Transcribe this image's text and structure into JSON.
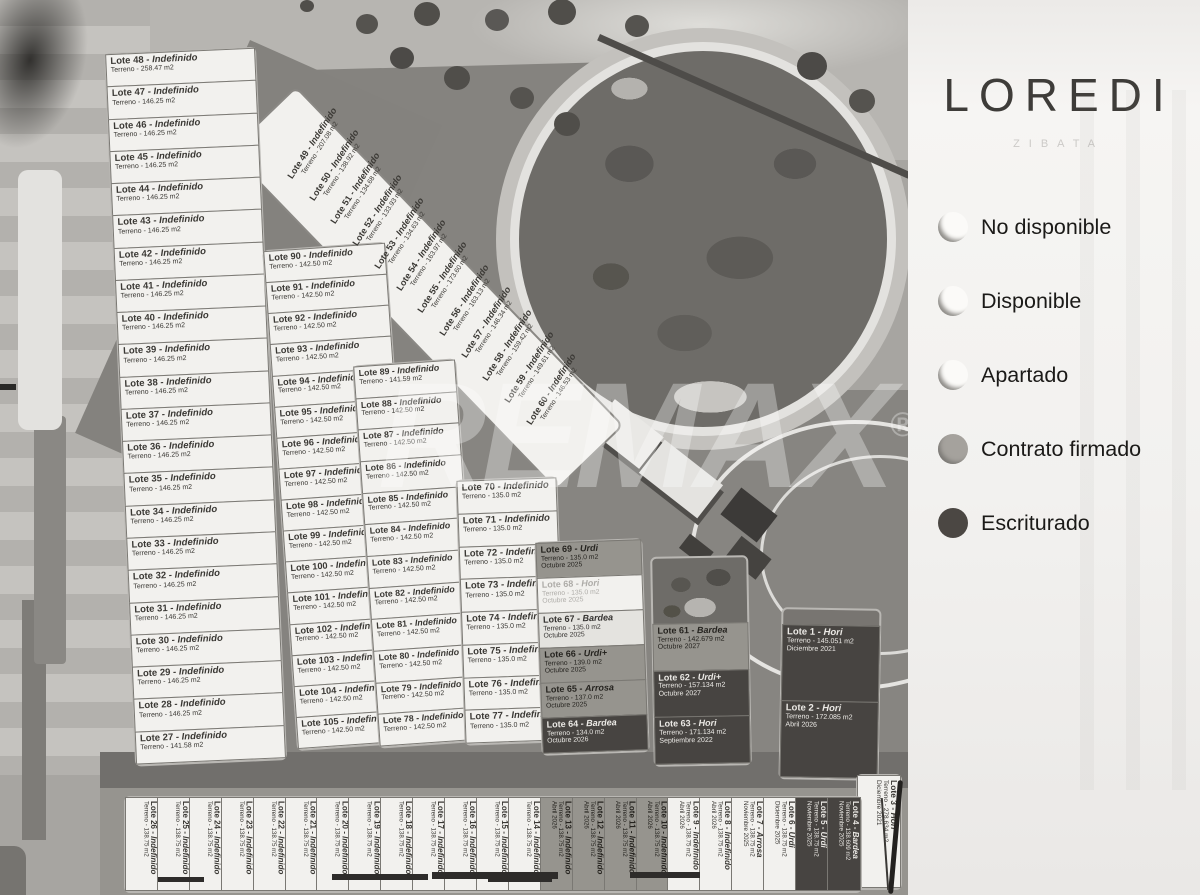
{
  "brand": {
    "title": "LOREDI",
    "subtitle": "ZIBATA"
  },
  "watermark": {
    "text": "REMAX",
    "reg": "®"
  },
  "legend": {
    "items": [
      {
        "label": "No disponible",
        "tone": "light",
        "color": "#fbfaf8"
      },
      {
        "label": "Disponible",
        "tone": "light",
        "color": "#fbfaf8"
      },
      {
        "label": "Apartado",
        "tone": "light",
        "color": "#fbfaf8"
      },
      {
        "label": "Contrato firmado",
        "tone": "mid",
        "color": "#a5a29d"
      },
      {
        "label": "Escriturado",
        "tone": "dark",
        "color": "#4b4743"
      }
    ]
  },
  "lots": {
    "left_column": [
      {
        "lot": "Lote 48",
        "name": "Indefinido",
        "terreno": "Terreno - 258.47 m2",
        "status": "white"
      },
      {
        "lot": "Lote 47",
        "name": "Indefinido",
        "terreno": "Terreno - 146.25 m2",
        "status": "white"
      },
      {
        "lot": "Lote 46",
        "name": "Indefinido",
        "terreno": "Terreno - 146.25 m2",
        "status": "white"
      },
      {
        "lot": "Lote 45",
        "name": "Indefinido",
        "terreno": "Terreno - 146.25 m2",
        "status": "white"
      },
      {
        "lot": "Lote 44",
        "name": "Indefinido",
        "terreno": "Terreno - 146.25 m2",
        "status": "white"
      },
      {
        "lot": "Lote 43",
        "name": "Indefinido",
        "terreno": "Terreno - 146.25 m2",
        "status": "white"
      },
      {
        "lot": "Lote 42",
        "name": "Indefinido",
        "terreno": "Terreno - 146.25 m2",
        "status": "white"
      },
      {
        "lot": "Lote 41",
        "name": "Indefinido",
        "terreno": "Terreno - 146.25 m2",
        "status": "white"
      },
      {
        "lot": "Lote 40",
        "name": "Indefinido",
        "terreno": "Terreno - 146.25 m2",
        "status": "white"
      },
      {
        "lot": "Lote 39",
        "name": "Indefinido",
        "terreno": "Terreno - 146.25 m2",
        "status": "white"
      },
      {
        "lot": "Lote 38",
        "name": "Indefinido",
        "terreno": "Terreno - 146.25 m2",
        "status": "white"
      },
      {
        "lot": "Lote 37",
        "name": "Indefinido",
        "terreno": "Terreno - 146.25 m2",
        "status": "white"
      },
      {
        "lot": "Lote 36",
        "name": "Indefinido",
        "terreno": "Terreno - 146.25 m2",
        "status": "white"
      },
      {
        "lot": "Lote 35",
        "name": "Indefinido",
        "terreno": "Terreno - 146.25 m2",
        "status": "white"
      },
      {
        "lot": "Lote 34",
        "name": "Indefinido",
        "terreno": "Terreno - 146.25 m2",
        "status": "white"
      },
      {
        "lot": "Lote 33",
        "name": "Indefinido",
        "terreno": "Terreno - 146.25 m2",
        "status": "white"
      },
      {
        "lot": "Lote 32",
        "name": "Indefinido",
        "terreno": "Terreno - 146.25 m2",
        "status": "white"
      },
      {
        "lot": "Lote 31",
        "name": "Indefinido",
        "terreno": "Terreno - 146.25 m2",
        "status": "white"
      },
      {
        "lot": "Lote 30",
        "name": "Indefinido",
        "terreno": "Terreno - 146.25 m2",
        "status": "white"
      },
      {
        "lot": "Lote 29",
        "name": "Indefinido",
        "terreno": "Terreno - 146.25 m2",
        "status": "white"
      },
      {
        "lot": "Lote 28",
        "name": "Indefinido",
        "terreno": "Terreno - 146.25 m2",
        "status": "white"
      },
      {
        "lot": "Lote 27",
        "name": "Indefinido",
        "terreno": "Terreno - 141.58 m2",
        "status": "white"
      }
    ],
    "diagonal": [
      {
        "lot": "Lote 49",
        "name": "Indefinido",
        "terreno": "Terreno - 207.08 m2",
        "status": "white"
      },
      {
        "lot": "Lote 50",
        "name": "Indefinido",
        "terreno": "Terreno - 138.92 m2",
        "status": "white"
      },
      {
        "lot": "Lote 51",
        "name": "Indefinido",
        "terreno": "Terreno - 134.68 m2",
        "status": "white"
      },
      {
        "lot": "Lote 52",
        "name": "Indefinido",
        "terreno": "Terreno - 133.93 m2",
        "status": "white"
      },
      {
        "lot": "Lote 53",
        "name": "Indefinido",
        "terreno": "Terreno - 134.63 m2",
        "status": "white"
      },
      {
        "lot": "Lote 54",
        "name": "Indefinido",
        "terreno": "Terreno - 163.97 m2",
        "status": "white"
      },
      {
        "lot": "Lote 55",
        "name": "Indefinido",
        "terreno": "Terreno - 173.60 m2",
        "status": "white"
      },
      {
        "lot": "Lote 56",
        "name": "Indefinido",
        "terreno": "Terreno - 163.13 m2",
        "status": "white"
      },
      {
        "lot": "Lote 57",
        "name": "Indefinido",
        "terreno": "Terreno - 146.34 m2",
        "status": "white"
      },
      {
        "lot": "Lote 58",
        "name": "Indefinido",
        "terreno": "Terreno - 159.42 m2",
        "status": "white"
      },
      {
        "lot": "Lote 59",
        "name": "Indefinido",
        "terreno": "Terreno - 149.61 m2",
        "status": "white"
      },
      {
        "lot": "Lote 60",
        "name": "Indefinido",
        "terreno": "Terreno - 146.53 m2",
        "status": "white"
      }
    ],
    "col_90s": [
      {
        "lot": "Lote 90",
        "name": "Indefinido",
        "terreno": "Terreno - 142.50 m2",
        "status": "white"
      },
      {
        "lot": "Lote 91",
        "name": "Indefinido",
        "terreno": "Terreno - 142.50 m2",
        "status": "white"
      },
      {
        "lot": "Lote 92",
        "name": "Indefinido",
        "terreno": "Terreno - 142.50 m2",
        "status": "white"
      },
      {
        "lot": "Lote 93",
        "name": "Indefinido",
        "terreno": "Terreno - 142.50 m2",
        "status": "white"
      },
      {
        "lot": "Lote 94",
        "name": "Indefinido",
        "terreno": "Terreno - 142.50 m2",
        "status": "white"
      },
      {
        "lot": "Lote 95",
        "name": "Indefinido",
        "terreno": "Terreno - 142.50 m2",
        "status": "white"
      },
      {
        "lot": "Lote 96",
        "name": "Indefinido",
        "terreno": "Terreno - 142.50 m2",
        "status": "white"
      },
      {
        "lot": "Lote 97",
        "name": "Indefinido",
        "terreno": "Terreno - 142.50 m2",
        "status": "white"
      },
      {
        "lot": "Lote 98",
        "name": "Indefinido",
        "terreno": "Terreno - 142.50 m2",
        "status": "white"
      },
      {
        "lot": "Lote 99",
        "name": "Indefinido",
        "terreno": "Terreno - 142.50 m2",
        "status": "white"
      },
      {
        "lot": "Lote 100",
        "name": "Indefinido",
        "terreno": "Terreno - 142.50 m2",
        "status": "white"
      },
      {
        "lot": "Lote 101",
        "name": "Indefinido",
        "terreno": "Terreno - 142.50 m2",
        "status": "white"
      },
      {
        "lot": "Lote 102",
        "name": "Indefinido",
        "terreno": "Terreno - 142.50 m2",
        "status": "white"
      },
      {
        "lot": "Lote 103",
        "name": "Indefinido",
        "terreno": "Terreno - 142.50 m2",
        "status": "white"
      },
      {
        "lot": "Lote 104",
        "name": "Indefinido",
        "terreno": "Terreno - 142.50 m2",
        "status": "white"
      },
      {
        "lot": "Lote 105",
        "name": "Indefinido",
        "terreno": "Terreno - 142.50 m2",
        "status": "white"
      }
    ],
    "col_80s": [
      {
        "lot": "Lote 89",
        "name": "Indefinido",
        "terreno": "Terreno - 141.59 m2",
        "status": "white"
      },
      {
        "lot": "Lote 88",
        "name": "Indefinido",
        "terreno": "Terreno - 142.50 m2",
        "status": "white"
      },
      {
        "lot": "Lote 87",
        "name": "Indefinido",
        "terreno": "Terreno - 142.50 m2",
        "status": "white"
      },
      {
        "lot": "Lote 86",
        "name": "Indefinido",
        "terreno": "Terreno - 142.50 m2",
        "status": "white"
      },
      {
        "lot": "Lote 85",
        "name": "Indefinido",
        "terreno": "Terreno - 142.50 m2",
        "status": "white"
      },
      {
        "lot": "Lote 84",
        "name": "Indefinido",
        "terreno": "Terreno - 142.50 m2",
        "status": "white"
      },
      {
        "lot": "Lote 83",
        "name": "Indefinido",
        "terreno": "Terreno - 142.50 m2",
        "status": "white"
      },
      {
        "lot": "Lote 82",
        "name": "Indefinido",
        "terreno": "Terreno - 142.50 m2",
        "status": "white"
      },
      {
        "lot": "Lote 81",
        "name": "Indefinido",
        "terreno": "Terreno - 142.50 m2",
        "status": "white"
      },
      {
        "lot": "Lote 80",
        "name": "Indefinido",
        "terreno": "Terreno - 142.50 m2",
        "status": "white"
      },
      {
        "lot": "Lote 79",
        "name": "Indefinido",
        "terreno": "Terreno - 142.50 m2",
        "status": "white"
      },
      {
        "lot": "Lote 78",
        "name": "Indefinido",
        "terreno": "Terreno - 142.50 m2",
        "status": "white"
      }
    ],
    "col_70s": [
      {
        "lot": "Lote 70",
        "name": "Indefinido",
        "terreno": "Terreno - 135.0 m2",
        "status": "white"
      },
      {
        "lot": "Lote 71",
        "name": "Indefinido",
        "terreno": "Terreno - 135.0 m2",
        "status": "white"
      },
      {
        "lot": "Lote 72",
        "name": "Indefinido",
        "terreno": "Terreno - 135.0 m2",
        "status": "white"
      },
      {
        "lot": "Lote 73",
        "name": "Indefinido",
        "terreno": "Terreno - 135.0 m2",
        "status": "white"
      },
      {
        "lot": "Lote 74",
        "name": "Indefinido",
        "terreno": "Terreno - 135.0 m2",
        "status": "white"
      },
      {
        "lot": "Lote 75",
        "name": "Indefinido",
        "terreno": "Terreno - 135.0 m2",
        "status": "white"
      },
      {
        "lot": "Lote 76",
        "name": "Indefinido",
        "terreno": "Terreno - 135.0 m2",
        "status": "white"
      },
      {
        "lot": "Lote 77",
        "name": "Indefinido",
        "terreno": "Terreno - 135.0 m2",
        "status": "white"
      }
    ],
    "col_60s": [
      {
        "lot": "Lote 69",
        "name": "Urdi",
        "terreno": "Terreno - 135.0 m2",
        "date": "Octubre 2025",
        "status": "gray"
      },
      {
        "lot": "Lote 68",
        "name": "Hori",
        "terreno": "Terreno - 135.0 m2",
        "date": "Octubre 2025",
        "status": "faint"
      },
      {
        "lot": "Lote 67",
        "name": "Bardea",
        "terreno": "Terreno - 135.0 m2",
        "date": "Octubre 2025",
        "status": "light"
      },
      {
        "lot": "Lote 66",
        "name": "Urdi+",
        "terreno": "Terreno - 139.0 m2",
        "date": "Octubre 2025",
        "status": "gray"
      },
      {
        "lot": "Lote 65",
        "name": "Arrosa",
        "terreno": "Terreno - 137.0 m2",
        "date": "Octubre 2025",
        "status": "gray"
      },
      {
        "lot": "Lote 64",
        "name": "Bardea",
        "terreno": "Terreno - 134.0 m2",
        "date": "Octubre 2026",
        "status": "dark"
      }
    ],
    "block_61_63": [
      {
        "lot": "Lote 61",
        "name": "Bardea",
        "terreno": "Terreno - 142.679 m2",
        "date": "Octubre 2027",
        "status": "gray"
      },
      {
        "lot": "Lote 62",
        "name": "Urdi+",
        "terreno": "Terreno - 157.134 m2",
        "date": "Octubre 2027",
        "status": "dark"
      },
      {
        "lot": "Lote 63",
        "name": "Hori",
        "terreno": "Terreno - 171.134 m2",
        "date": "Septiembre 2022",
        "status": "dark"
      }
    ],
    "block_1_2": [
      {
        "lot": "Lote 1",
        "name": "Hori",
        "terreno": "Terreno - 145.051 m2",
        "date": "Diciembre 2021",
        "status": "dark"
      },
      {
        "lot": "Lote 2",
        "name": "Hori",
        "terreno": "Terreno - 172.085 m2",
        "date": "Abril 2026",
        "status": "dark"
      }
    ],
    "lot_3": [
      {
        "lot": "Lote 3",
        "name": "Hori",
        "terreno": "Terreno - 278.634 m2",
        "date": "Diciembre 2021",
        "status": "white"
      }
    ],
    "bottom_row": [
      {
        "lot": "Lote 26",
        "name": "Indefinido",
        "terreno": "Terreno - 138.75 m2",
        "status": "white"
      },
      {
        "lot": "Lote 25",
        "name": "Indefinido",
        "terreno": "Terreno - 138.75 m2",
        "status": "white"
      },
      {
        "lot": "Lote 24",
        "name": "Indefinido",
        "terreno": "Terreno - 138.75 m2",
        "status": "white"
      },
      {
        "lot": "Lote 23",
        "name": "Indefinido",
        "terreno": "Terreno - 138.75 m2",
        "status": "white"
      },
      {
        "lot": "Lote 22",
        "name": "Indefinido",
        "terreno": "Terreno - 138.75 m2",
        "status": "white"
      },
      {
        "lot": "Lote 21",
        "name": "Indefinido",
        "terreno": "Terreno - 138.75 m2",
        "status": "white"
      },
      {
        "lot": "Lote 20",
        "name": "Indefinido",
        "terreno": "Terreno - 138.75 m2",
        "status": "white"
      },
      {
        "lot": "Lote 19",
        "name": "Indefinido",
        "terreno": "Terreno - 138.75 m2",
        "status": "white"
      },
      {
        "lot": "Lote 18",
        "name": "Indefinido",
        "terreno": "Terreno - 138.75 m2",
        "status": "white"
      },
      {
        "lot": "Lote 17",
        "name": "Indefinido",
        "terreno": "Terreno - 138.75 m2",
        "status": "white"
      },
      {
        "lot": "Lote 16",
        "name": "Indefinido",
        "terreno": "Terreno - 138.75 m2",
        "status": "white"
      },
      {
        "lot": "Lote 15",
        "name": "Indefinido",
        "terreno": "Terreno - 138.75 m2",
        "status": "white"
      },
      {
        "lot": "Lote 14",
        "name": "Indefinido",
        "terreno": "Terreno - 138.75 m2",
        "status": "white"
      },
      {
        "lot": "Lote 13",
        "name": "Indefinido",
        "terreno": "Terreno - 138.75 m2",
        "date": "Abril 2026",
        "status": "gray"
      },
      {
        "lot": "Lote 12",
        "name": "Indefinido",
        "terreno": "Terreno - 138.75 m2",
        "date": "Abril 2026",
        "status": "gray"
      },
      {
        "lot": "Lote 11",
        "name": "Indefinido",
        "terreno": "Terreno - 138.75 m2",
        "date": "Abril 2026",
        "status": "gray"
      },
      {
        "lot": "Lote 10",
        "name": "Indefinido",
        "terreno": "Terreno - 138.75 m2",
        "date": "Abril 2026",
        "status": "gray"
      },
      {
        "lot": "Lote 9",
        "name": "Indefinido",
        "terreno": "Terreno - 138.75 m2",
        "date": "Abril 2026",
        "status": "white"
      },
      {
        "lot": "Lote 8",
        "name": "Indefinido",
        "terreno": "Terreno - 138.75 m2",
        "date": "Abril 2026",
        "status": "white"
      },
      {
        "lot": "Lote 7",
        "name": "Arrosa",
        "terreno": "Terreno - 138.75 m2",
        "date": "Noviembre 2025",
        "status": "white"
      },
      {
        "lot": "Lote 6",
        "name": "Urdi",
        "terreno": "Terreno - 138.75 m2",
        "date": "Diciembre 2025",
        "status": "white"
      },
      {
        "lot": "Lote 5",
        "name": "Urdi",
        "terreno": "Terreno - 138.75 m2",
        "date": "Noviembre 2025",
        "status": "dark"
      },
      {
        "lot": "Lote 4",
        "name": "Bardea",
        "terreno": "Terreno - 138.609 m2",
        "date": "Noviembre 2025",
        "status": "dark"
      }
    ]
  }
}
